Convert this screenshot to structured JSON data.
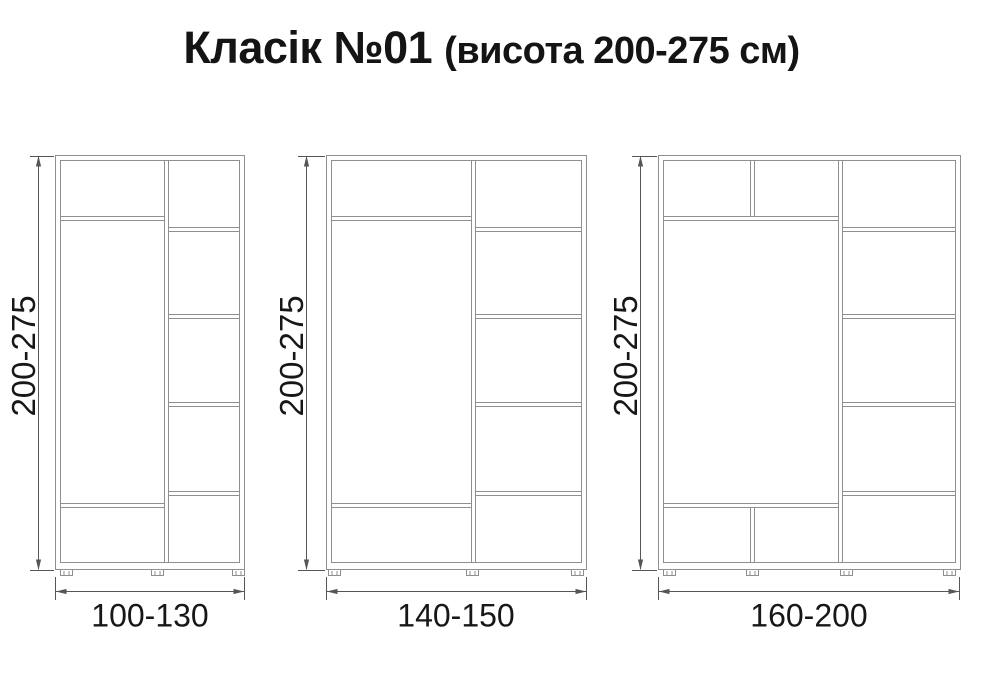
{
  "page": {
    "title_main": "Класік №01",
    "title_sub": "(висота 200-275 см)",
    "background": "#ffffff"
  },
  "colors": {
    "cabinet_line": "#8f8f8f",
    "dimension_line": "#565656",
    "label_text": "#171717"
  },
  "wardrobes": [
    {
      "id": "wardrobe-1",
      "height_label": "200-275",
      "width_label": "100-130"
    },
    {
      "id": "wardrobe-2",
      "height_label": "200-275",
      "width_label": "140-150"
    },
    {
      "id": "wardrobe-3",
      "height_label": "200-275",
      "width_label": "160-200"
    }
  ]
}
